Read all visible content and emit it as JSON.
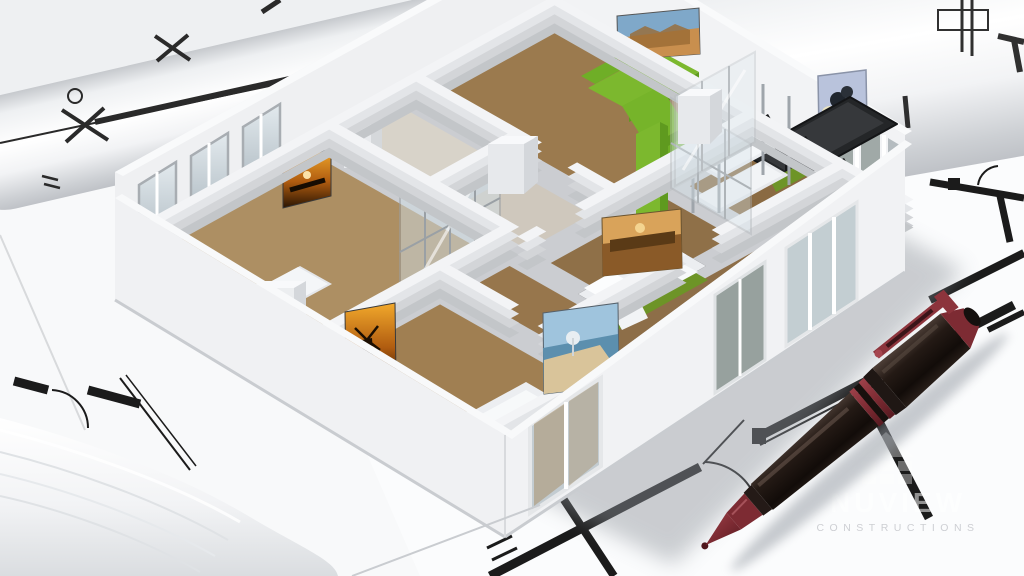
{
  "meta": {
    "title": "3D cutaway apartment model standing on architectural blueprints with a ballpoint pen"
  },
  "watermark": {
    "brand": "NUVIEW",
    "subtitle": "CONSTRUCTIONS",
    "logo_icon": "house-grid-icon"
  },
  "palette": {
    "paper": "#eef0f2",
    "paper-bright": "#f8f9fa",
    "ink": "#1b1b1b",
    "wall-top": "#f3f4f6",
    "wall-face": "#eff0f2",
    "wall-side": "#c3c6c9",
    "wood": "#9b7a4e",
    "wood-dark": "#8a6a42",
    "wood-light": "#ad8f63",
    "tile": "#d8d3c9",
    "sofa-green": "#7cb82e",
    "sofa-green-dark": "#5f9a1f",
    "bed-green": "#6d9427",
    "glass": "#cdd6da",
    "glass-dark": "#97a19e",
    "table-black": "#242628",
    "pen-maroon": "#8c343c",
    "shadow": "#9298a0"
  },
  "scene": {
    "model": "cutaway apartment 3D model",
    "rooms": [
      "living-dining room",
      "bunk-bed room",
      "bedroom",
      "bedroom",
      "bedroom",
      "hallway",
      "bathroom"
    ],
    "furniture": [
      "green sectional sofa",
      "black dining table with chairs",
      "bed",
      "bed",
      "bed",
      "bunk bed",
      "glass wardrobe"
    ],
    "artworks": [
      "city skyline picture",
      "fruit still life picture",
      "harbor sunset picture",
      "orange sunset picture",
      "windmill silhouette picture",
      "beach picture"
    ],
    "props": [
      "rolled blueprint tube",
      "rolled blueprint corner",
      "blueprint floor plans",
      "ballpoint pen"
    ]
  }
}
